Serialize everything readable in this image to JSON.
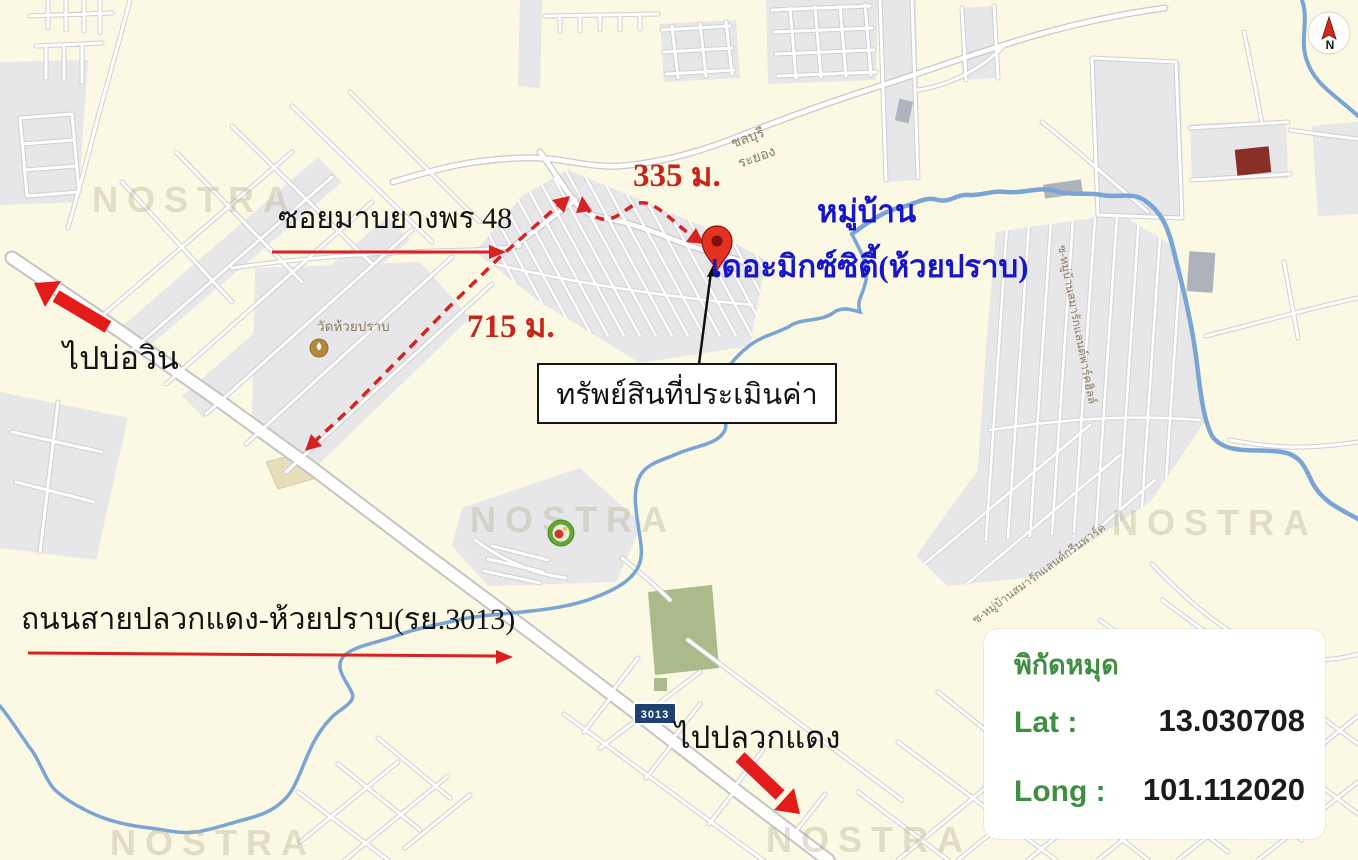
{
  "map": {
    "watermark": "NOSTRA",
    "compass": {
      "label": "N"
    },
    "road_shield": "3013",
    "road_labels": {
      "chonburi": "ชลบุรี",
      "rayong": "ระยอง"
    },
    "street_labels": {
      "park_hill": "ซ-หมู่บ้านสมารักแลนด์พาร์คฮิลล์",
      "green_park": "ซ-หมู่บ้านสมารักแลนด์กรีนพาร์ค"
    },
    "poi": {
      "temple": "วัดห้วยปราบ"
    }
  },
  "annotations": {
    "soi_label": "ซอยมาบยางพร 48",
    "distance_soi": "335 ม.",
    "distance_main": "715 ม.",
    "direction_northwest": "ไปบ่อวิน",
    "village_line1": "หมู่บ้าน",
    "village_line2": "เดอะมิกซ์ซิตี้(ห้วยปราบ)",
    "property_label": "ทรัพย์สินที่ประเมินค่า",
    "main_road_label": "ถนนสายปลวกแดง-ห้วยปราบ(รย.3013)",
    "direction_southeast": "ไปปลวกแดง"
  },
  "legend": {
    "title": "พิกัดหมุด",
    "lat_label": "Lat :",
    "lat_value": "13.030708",
    "long_label": "Long :",
    "long_value": "101.112020"
  },
  "colors": {
    "map_background": "#fbf9e3",
    "urban_block": "#e7e6e8",
    "road_fill": "#ffffff",
    "road_casing": "#c9c9c9",
    "water": "#7aa4d4",
    "green_area": "#aaba8a",
    "annotation_red": "#d92121",
    "annotation_blue": "#1616c8",
    "legend_green": "#3f8f42",
    "pin_red": "#e23222",
    "shield_navy": "#20406f"
  }
}
